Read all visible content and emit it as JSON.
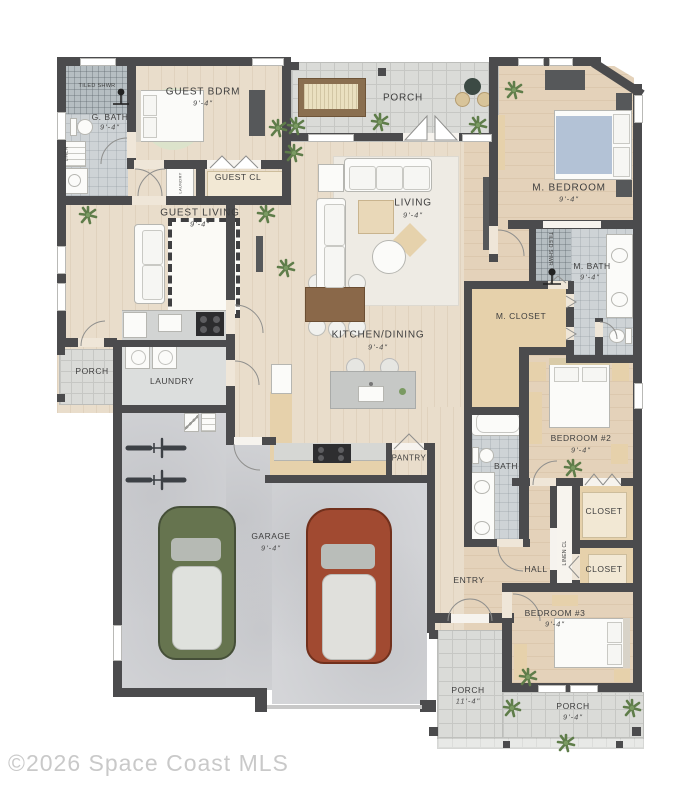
{
  "watermark": "©2026 Space Coast MLS",
  "labels": {
    "tiled_shwr_guest": "TILED SHWR",
    "g_bath": "G. BATH",
    "guest_bdrm": "GUEST BDRM",
    "guest_cl": "GUEST CL",
    "linen_guest": "LINEN",
    "laundry_closet": "LAUNDRY",
    "porch_top": "PORCH",
    "m_bedroom": "M. BEDROOM",
    "living": "LIVING",
    "guest_living": "GUEST LIVING",
    "tiled_shwr_master": "TILED SHWR",
    "m_bath": "M. BATH",
    "m_closet": "M. CLOSET",
    "kitchen_dining": "KITCHEN/DINING",
    "porch_left": "PORCH",
    "laundry": "LAUNDRY",
    "pantry": "PANTRY",
    "bath": "BATH",
    "bedroom_2": "BEDROOM #2",
    "garage": "GARAGE",
    "entry": "ENTRY",
    "hall": "HALL",
    "linen_cl": "LINEN CL",
    "closet_1": "CLOSET",
    "closet_2": "CLOSET",
    "bedroom_3": "BEDROOM #3",
    "porch_entry": "PORCH",
    "porch_bottom": "PORCH"
  },
  "dims": {
    "g_bath": "9'-4\"",
    "guest_bdrm": "9'-4\"",
    "m_bedroom": "9'-4\"",
    "living": "9'-4\"",
    "guest_living": "9'-4\"",
    "m_bath": "9'-4\"",
    "kitchen_dining": "9'-4\"",
    "bedroom_2": "9'-4\"",
    "garage": "9'-4\"",
    "bedroom_3": "9'-4\"",
    "porch_entry": "11'-4\"",
    "porch_bottom": "9'-4\""
  },
  "colors": {
    "wall": "#4b4b4d",
    "wood_floor": "#e9ddcb",
    "warm_wood_floor": "#e4d2ba",
    "porch_tile": "#dadbd8",
    "bath_tile": "#ced3d6",
    "shower_tile": "#b6bec2",
    "closet_carpet": "#cbd0d4",
    "garage_floor": "#d4d5d8",
    "cabinet_tan": "#e6d1ab",
    "bed_blue": "#b3c2d6",
    "rug_green": "#dce3cb",
    "car_green": "#66744f",
    "car_red": "#a14a31",
    "plant_green": "#5f7d4a",
    "label_text": "#3e3e3e",
    "watermark_gray": "#c9c9c9"
  }
}
